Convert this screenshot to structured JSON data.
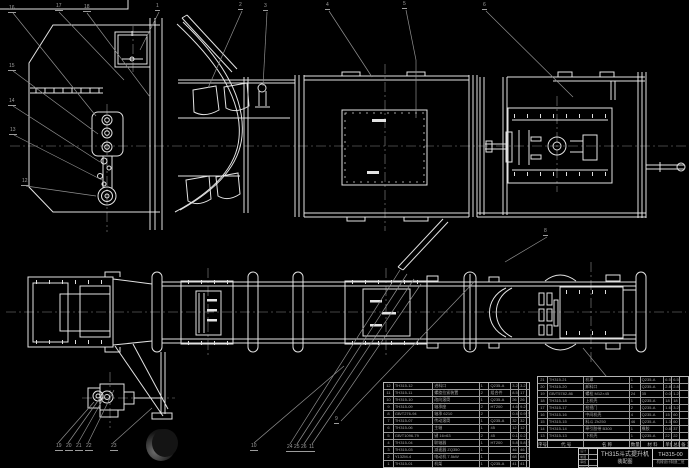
{
  "drawing": {
    "title": "TH315斗式提升机",
    "subtitle": "装配图",
    "number": "TH315-00",
    "org": "机械设计制造二班"
  },
  "colors": {
    "line": "#e2e2e2",
    "aux": "#8f8f8f",
    "table_text": "#a8a8a8"
  },
  "bom": {
    "header": [
      "序号",
      "代 号",
      "名 称",
      "数量",
      "材 料",
      "单件",
      "总计",
      "备 注"
    ],
    "left_rows": [
      [
        "12",
        "TH315-12",
        "进料口",
        "1",
        "Q235-A",
        "3.2",
        "3.2",
        ""
      ],
      [
        "11",
        "TH315-11",
        "螺旋拉紧装置",
        "2",
        "组合件",
        "8.5",
        "17",
        ""
      ],
      [
        "10",
        "TH315-10",
        "改向滚筒",
        "1",
        "Q235-A",
        "26",
        "26",
        ""
      ],
      [
        "9",
        "TH315-09",
        "轴承座",
        "2",
        "HT200",
        "4.6",
        "9.2",
        ""
      ],
      [
        "8",
        "GB/T276-94",
        "轴承 6210",
        "2",
        "",
        "0.46",
        "0.9",
        "外购"
      ],
      [
        "7",
        "TH315-07",
        "传动滚筒",
        "1",
        "Q235-A",
        "32",
        "32",
        ""
      ],
      [
        "6",
        "TH315-06",
        "主轴",
        "1",
        "45",
        "12",
        "12",
        ""
      ],
      [
        "5",
        "GB/T1096-79",
        "键 16×63",
        "2",
        "45",
        "0.1",
        "0.2",
        ""
      ],
      [
        "4",
        "TH315-04",
        "联轴器",
        "1",
        "HT200",
        "5.8",
        "5.8",
        "外购"
      ],
      [
        "3",
        "TH315-03",
        "减速器 ZQ350",
        "1",
        "",
        "46",
        "46",
        "外购"
      ],
      [
        "2",
        "Y132M-4",
        "电动机 7.5kW",
        "1",
        "",
        "68",
        "68",
        "外购"
      ],
      [
        "1",
        "TH315-01",
        "机架",
        "1",
        "Q235-A",
        "41",
        "41",
        ""
      ]
    ],
    "right_rows": [
      [
        "21",
        "TH315-21",
        "机罩",
        "1",
        "Q235-A",
        "6.5",
        "6.5",
        ""
      ],
      [
        "20",
        "TH315-20",
        "卸料口",
        "1",
        "Q235-A",
        "2.8",
        "2.8",
        ""
      ],
      [
        "19",
        "GB/T5782-86",
        "螺栓 M12×45",
        "24",
        "35",
        "0.05",
        "1.2",
        ""
      ],
      [
        "18",
        "TH315-18",
        "上机壳",
        "1",
        "Q235-A",
        "18",
        "18",
        ""
      ],
      [
        "17",
        "TH315-17",
        "检视门",
        "2",
        "Q235-A",
        "1.6",
        "3.2",
        ""
      ],
      [
        "16",
        "TH315-16",
        "中间机壳",
        "4",
        "Q235-A",
        "15",
        "60",
        ""
      ],
      [
        "15",
        "TH315-15",
        "料斗 Zh250",
        "46",
        "Q235-A",
        "1.3",
        "60",
        ""
      ],
      [
        "14",
        "TH315-14",
        "牵引胶带 B300",
        "1",
        "橡胶",
        "0.8",
        "37",
        ""
      ],
      [
        "13",
        "TH315-13",
        "下机壳",
        "1",
        "Q235-A",
        "22",
        "22",
        ""
      ]
    ]
  },
  "title_block": {
    "sig_rows": [
      [
        "设计",
        ""
      ],
      [
        "制图",
        ""
      ],
      [
        "审核",
        ""
      ],
      [
        "批准",
        ""
      ]
    ]
  },
  "balloons": [
    {
      "label": "16",
      "x": 8,
      "y": 6
    },
    {
      "label": "15",
      "x": 8,
      "y": 64
    },
    {
      "label": "14",
      "x": 8,
      "y": 99
    },
    {
      "label": "13",
      "x": 9,
      "y": 128
    },
    {
      "label": "12",
      "x": 21,
      "y": 179
    },
    {
      "label": "17",
      "x": 55,
      "y": 4
    },
    {
      "label": "18",
      "x": 83,
      "y": 5
    },
    {
      "label": "1",
      "x": 155,
      "y": 4
    },
    {
      "label": "2",
      "x": 238,
      "y": 3
    },
    {
      "label": "3",
      "x": 263,
      "y": 4
    },
    {
      "label": "4",
      "x": 325,
      "y": 3
    },
    {
      "label": "5",
      "x": 402,
      "y": 2
    },
    {
      "label": "6",
      "x": 482,
      "y": 3
    },
    {
      "label": "8",
      "x": 543,
      "y": 229
    },
    {
      "label": "9",
      "x": 334,
      "y": 417
    },
    {
      "label": "19",
      "x": 55,
      "y": 444
    },
    {
      "label": "20",
      "x": 65,
      "y": 444
    },
    {
      "label": "21",
      "x": 75,
      "y": 444
    },
    {
      "label": "22",
      "x": 85,
      "y": 444
    },
    {
      "label": "23",
      "x": 110,
      "y": 444
    },
    {
      "label": "10",
      "x": 250,
      "y": 444
    },
    {
      "label": "24",
      "x": 286,
      "y": 445
    },
    {
      "label": "25",
      "x": 293,
      "y": 445
    },
    {
      "label": "26",
      "x": 300,
      "y": 445
    },
    {
      "label": "11",
      "x": 308,
      "y": 445
    }
  ]
}
